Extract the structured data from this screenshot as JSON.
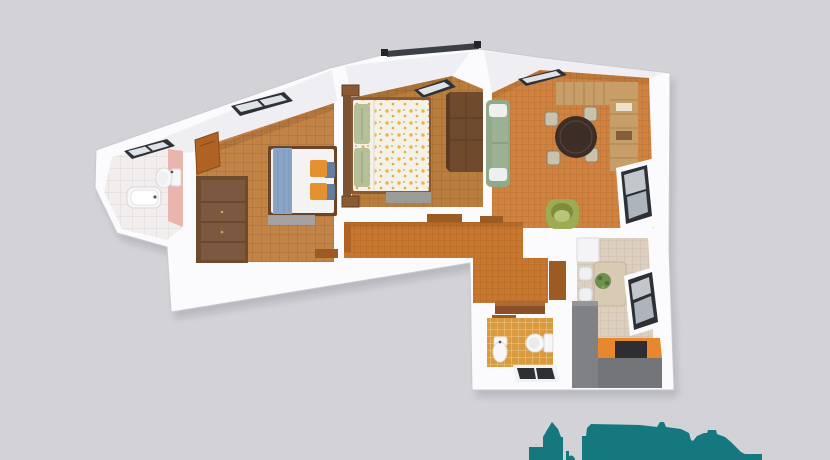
{
  "scene": {
    "description": "3d-rendered-apartment-floor-plan-top-view",
    "colors": {
      "background": "#d3d3d7",
      "wall": "#fbfbfd",
      "wall_shade": "#efeff3",
      "skyline_teal": "#15787e",
      "floor_bathroom": "#f2eeee",
      "floor_bedroom1": "#c28347",
      "floor_bedroom2": "#b97e3e",
      "floor_living": "#d08340",
      "floor_hallway": "#c8772e",
      "floor_wc": "#d99a3f",
      "floor_kitchen": "#dccfc0",
      "bathroom_pink_wall": "#e9b5ac",
      "wood_dark": "#6f4a2d",
      "wood_mid": "#8a5a33",
      "door_wood": "#b06224",
      "threshold_wood": "#9c5b22",
      "rustic_wood": "#c79e68",
      "sofa_green": "#90a98b",
      "armchair_green": "#9dac52",
      "dining_table_brown": "#3c2e27",
      "chair_beige": "#cbc2ad",
      "counter_gray": "#7f8184",
      "counter_front_gray": "#737578",
      "worktop_orange": "#e8882e",
      "appliance_black": "#2e2e30",
      "duvet_white": "#f3f3f4",
      "duvet_cream": "#f4f1e8",
      "blanket_blue": "#8aa5c7",
      "pillow_orange": "#e6912f",
      "pillow_blue": "#647e9e",
      "pillow_green": "#b5c098",
      "rug_gray": "#a3a5a9",
      "rug_gray2": "#9b9b98",
      "window_frame": "#2d3136",
      "window_pane": "#c2c7cd",
      "window_pane_light": "#dfe3e8",
      "fixture_white": "#f7f7f9",
      "roof_rail": "#3c4046",
      "plant_green": "#6f8f4f"
    },
    "rooms": [
      {
        "name": "bathroom",
        "fixtures": [
          "bathtub",
          "toilet",
          "pink-accent-wall",
          "skylight-window"
        ]
      },
      {
        "name": "bedroom-1",
        "furniture": [
          "open-door",
          "wardrobe",
          "double-bed-blue-blanket",
          "orange-pillows",
          "blue-pillows",
          "rug",
          "skylight-window"
        ]
      },
      {
        "name": "bedroom-2",
        "furniture": [
          "double-bed-yellow-floral-duvet",
          "green-pillows",
          "nightstands",
          "wardrobe",
          "rug",
          "skylight-window"
        ]
      },
      {
        "name": "living-dining-room",
        "furniture": [
          "green-sofa",
          "round-dining-table",
          "four-beige-chairs",
          "rustic-shelving-unit",
          "green-armchair",
          "wall-window",
          "skylight-window"
        ]
      },
      {
        "name": "hallway",
        "furniture": [
          "door-thresholds",
          "open-door",
          "low-cabinet"
        ]
      },
      {
        "name": "wc",
        "fixtures": [
          "toilet",
          "bidet",
          "skylight-window"
        ]
      },
      {
        "name": "kitchen",
        "furniture": [
          "dining-table",
          "four-white-chairs",
          "plant",
          "gray-counter",
          "orange-worktop",
          "appliance",
          "wall-window",
          "white-cabinet"
        ]
      }
    ],
    "watermark": "teal-city-skyline-silhouette"
  }
}
